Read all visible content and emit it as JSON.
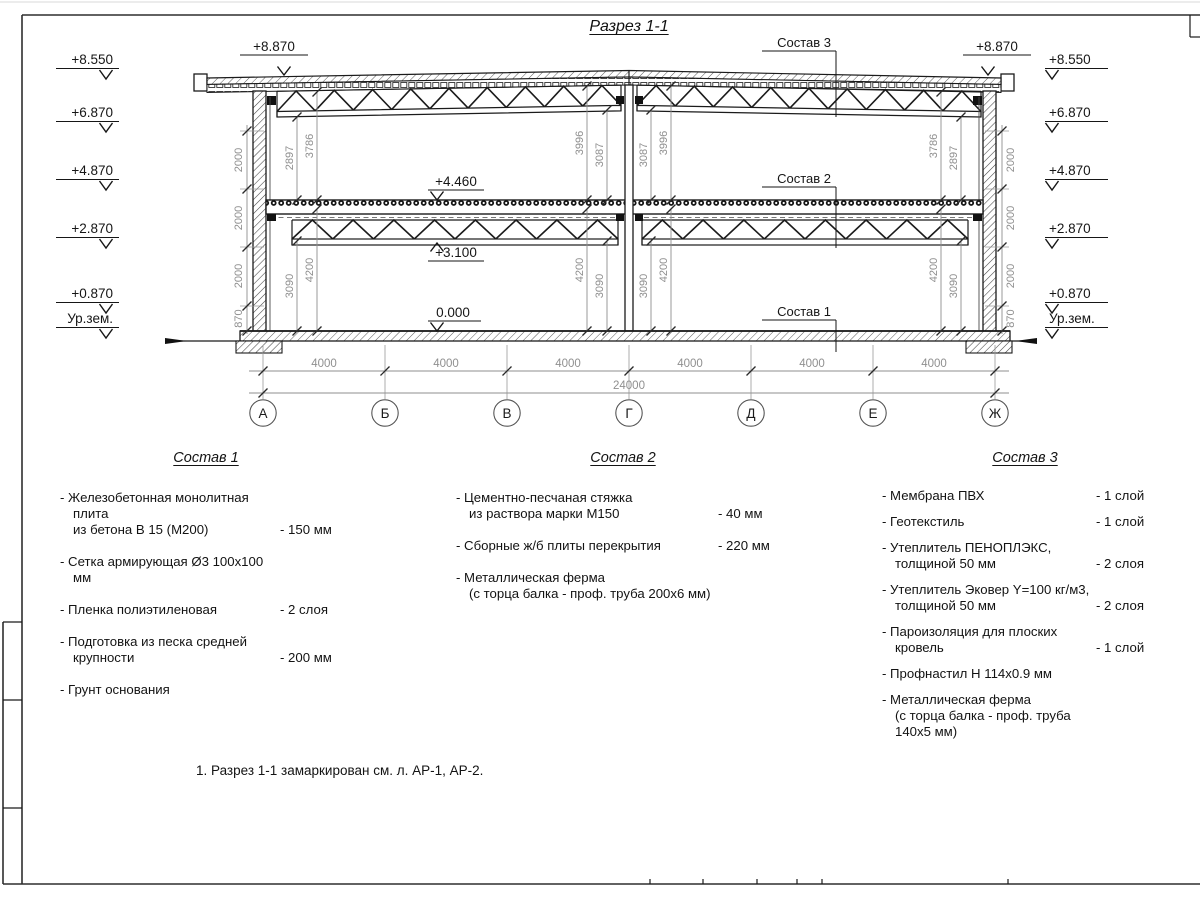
{
  "sheet": {
    "title": "Разрез 1-1",
    "note": "1. Разрез 1-1 замаркирован см. л. АР-1, АР-2."
  },
  "drawing": {
    "grid": [
      "А",
      "Б",
      "В",
      "Г",
      "Д",
      "Е",
      "Ж"
    ],
    "bays": [
      "4000",
      "4000",
      "4000",
      "4000",
      "4000",
      "4000"
    ],
    "total": "24000",
    "elev": [
      "+8.550",
      "+6.870",
      "+4.870",
      "+2.870",
      "+0.870",
      "Ур.зем."
    ],
    "parapet": "+8.870",
    "marks": {
      "floor": "+4.460",
      "truss": "+3.100",
      "zero": "0.000"
    },
    "vchain": [
      "2000",
      "2000",
      "2000",
      "870"
    ],
    "upper": [
      "2897",
      "3786",
      "3996",
      "3087",
      "3087",
      "3996",
      "3786",
      "2897"
    ],
    "lower": [
      "3090",
      "4200",
      "4200",
      "3090",
      "3090",
      "4200",
      "4200",
      "3090"
    ],
    "leaders": [
      "Состав 3",
      "Состав 2",
      "Состав 1"
    ]
  },
  "compositions": [
    {
      "title": "Состав 1",
      "items": [
        {
          "line1": "- Железобетонная  монолитная плита",
          "line2": "из бетона В 15 (М200)",
          "value": "- 150 мм"
        },
        {
          "line1": "- Сетка армирующая Ø3 100х100 мм",
          "value": ""
        },
        {
          "line1": "- Пленка полиэтиленовая",
          "value": "-  2 слоя"
        },
        {
          "line1": "- Подготовка из песка средней",
          "line2": "крупности",
          "value": "- 200 мм"
        },
        {
          "line1": "- Грунт основания",
          "value": ""
        }
      ]
    },
    {
      "title": "Состав 2",
      "items": [
        {
          "line1": "- Цементно-песчаная стяжка",
          "line2": "из раствора марки М150",
          "value": "- 40 мм"
        },
        {
          "line1": "- Сборные ж/б плиты перекрытия",
          "value": "- 220 мм"
        },
        {
          "line1": "- Металлическая ферма",
          "line2": "(с торца балка - проф. труба 200х6 мм)",
          "value": ""
        }
      ]
    },
    {
      "title": "Состав 3",
      "items": [
        {
          "line1": "- Мембрана ПВХ",
          "value": "- 1 слой"
        },
        {
          "line1": "- Геотекстиль",
          "value": "- 1 слой"
        },
        {
          "line1": "- Утеплитель ПЕНОПЛЭКС,",
          "line2": "толщиной 50 мм",
          "value": "- 2 слоя"
        },
        {
          "line1": "- Утеплитель Эковер Y=100 кг/м3,",
          "line2": "толщиной 50 мм",
          "value": "- 2 слоя"
        },
        {
          "line1": "- Пароизоляция для плоских кровель",
          "value": "- 1 слой"
        },
        {
          "line1": "- Профнастил Н 114х0.9 мм",
          "value": ""
        },
        {
          "line1": "- Металлическая ферма",
          "line2": "(с торца балка - проф. труба 140х5 мм)",
          "value": ""
        }
      ]
    }
  ]
}
